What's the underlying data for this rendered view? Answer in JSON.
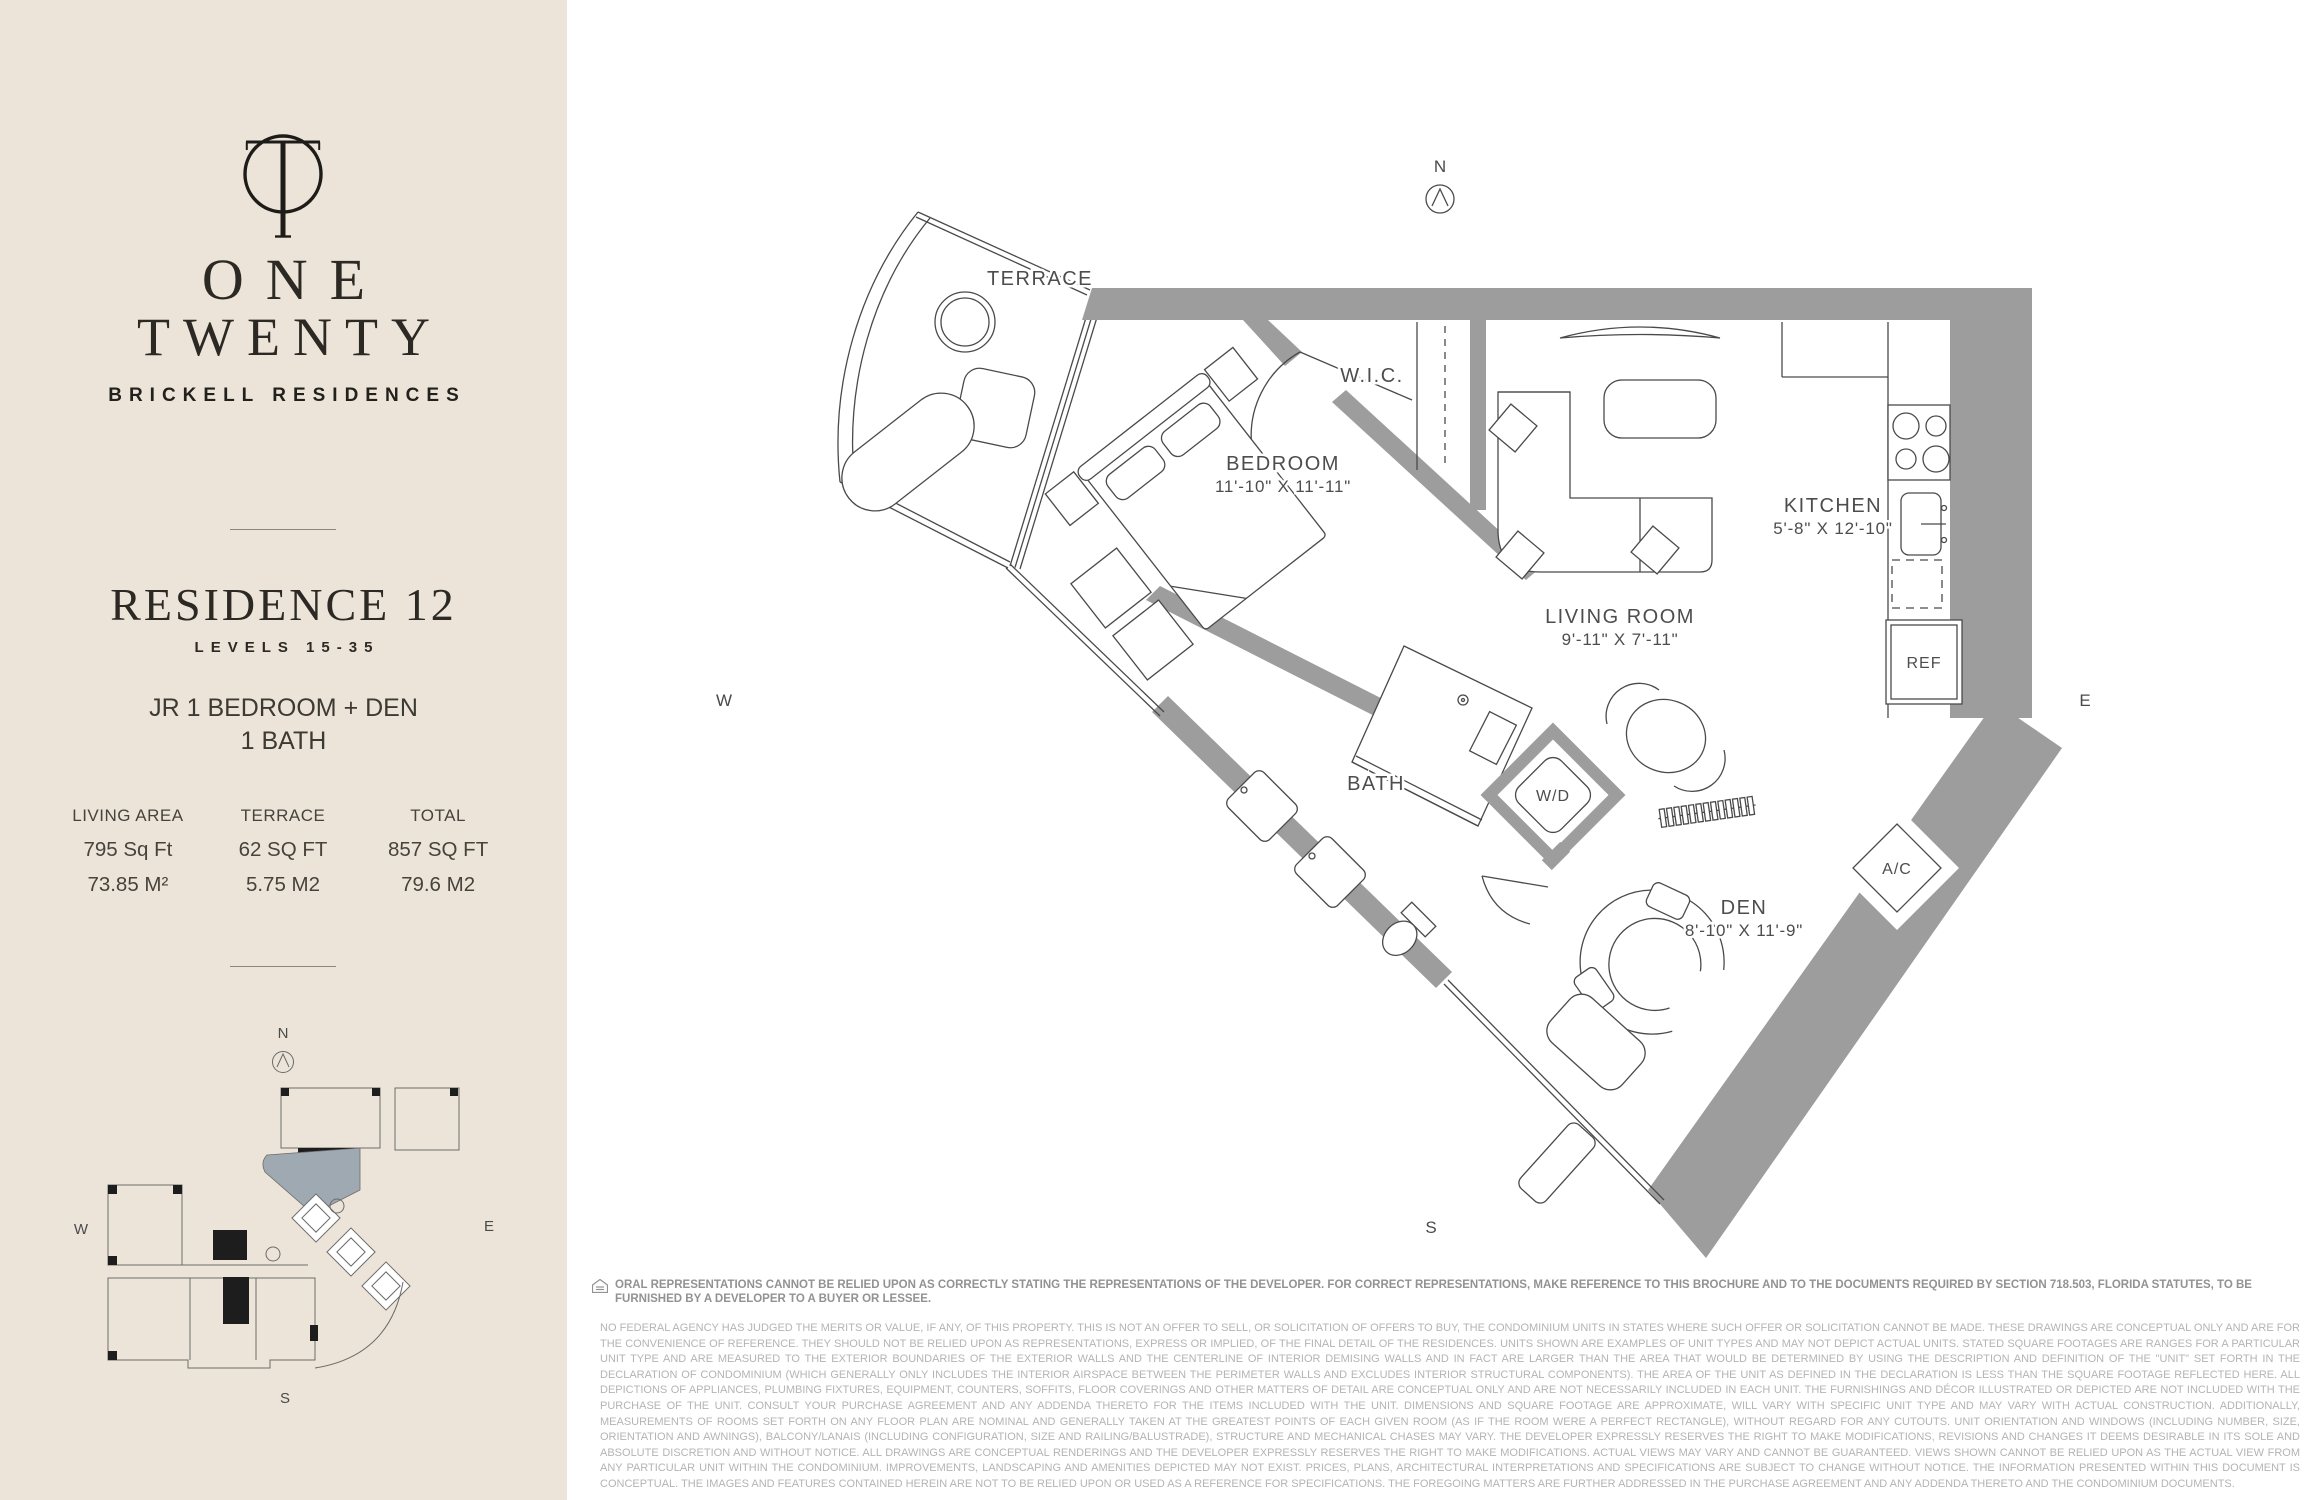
{
  "sidebar": {
    "bg_color": "#ece4d8",
    "brand": {
      "name_line1": "ONE",
      "name_line2": "TWENTY",
      "tagline": "BRICKELL RESIDENCES"
    },
    "residence": {
      "title": "RESIDENCE 12",
      "levels": "LEVELS 15-35",
      "type_line1": "JR 1 BEDROOM + DEN",
      "type_line2": "1 BATH"
    },
    "stats": {
      "columns": [
        {
          "label": "LIVING AREA",
          "imperial": "795 Sq Ft",
          "metric": "73.85 M²"
        },
        {
          "label": "TERRACE",
          "imperial": "62 SQ FT",
          "metric": "5.75 M2"
        },
        {
          "label": "TOTAL",
          "imperial": "857 SQ FT",
          "metric": "79.6 M2"
        }
      ]
    },
    "keyplan": {
      "highlight_color": "#9fa9b2",
      "compass": {
        "n": "N",
        "s": "S",
        "e": "E",
        "w": "W"
      }
    }
  },
  "floorplan": {
    "wall_color": "#9d9d9d",
    "compass": {
      "n": "N",
      "s": "S",
      "e": "E",
      "w": "W"
    },
    "rooms": {
      "terrace": {
        "name": "TERRACE"
      },
      "wic": {
        "name": "W.I.C."
      },
      "bedroom": {
        "name": "BEDROOM",
        "dims": "11'-10\" X 11'-11\""
      },
      "kitchen": {
        "name": "KITCHEN",
        "dims": "5'-8\" X 12'-10\""
      },
      "living": {
        "name": "LIVING ROOM",
        "dims": "9'-11\" X 7'-11\""
      },
      "bath": {
        "name": "BATH"
      },
      "wd": {
        "name": "W/D"
      },
      "den": {
        "name": "DEN",
        "dims": "8'-10\" X 11'-9\""
      },
      "ac": {
        "name": "A/C"
      },
      "ref": {
        "name": "REF"
      }
    }
  },
  "disclaimer": {
    "notice": "ORAL REPRESENTATIONS CANNOT BE RELIED UPON AS CORRECTLY STATING THE REPRESENTATIONS OF THE DEVELOPER. FOR CORRECT REPRESENTATIONS, MAKE REFERENCE TO THIS BROCHURE AND TO THE DOCUMENTS REQUIRED BY SECTION 718.503, FLORIDA STATUTES, TO BE FURNISHED BY A DEVELOPER TO A BUYER OR LESSEE.",
    "body": "NO FEDERAL AGENCY HAS JUDGED THE MERITS OR VALUE, IF ANY, OF THIS PROPERTY. THIS IS NOT AN OFFER TO SELL, OR SOLICITATION OF OFFERS TO BUY, THE CONDOMINIUM UNITS IN STATES WHERE SUCH OFFER OR SOLICITATION CANNOT BE MADE. THESE DRAWINGS ARE CONCEPTUAL ONLY AND ARE FOR THE CONVENIENCE OF REFERENCE. THEY SHOULD NOT BE RELIED UPON AS REPRESENTATIONS, EXPRESS OR IMPLIED, OF THE FINAL DETAIL OF THE RESIDENCES. UNITS SHOWN ARE EXAMPLES OF UNIT TYPES AND MAY NOT DEPICT ACTUAL UNITS. STATED SQUARE FOOTAGES ARE RANGES FOR A PARTICULAR UNIT TYPE AND ARE MEASURED TO THE EXTERIOR BOUNDARIES OF THE EXTERIOR WALLS AND THE CENTERLINE OF INTERIOR DEMISING WALLS AND IN FACT ARE LARGER THAN THE AREA THAT WOULD BE DETERMINED BY USING THE DESCRIPTION AND DEFINITION OF THE \"UNIT\" SET FORTH IN THE DECLARATION OF CONDOMINIUM (WHICH GENERALLY ONLY INCLUDES THE INTERIOR AIRSPACE BETWEEN THE PERIMETER WALLS AND EXCLUDES INTERIOR STRUCTURAL COMPONENTS). THE AREA OF THE UNIT AS DEFINED IN THE DECLARATION IS LESS THAN THE SQUARE FOOTAGE REFLECTED HERE. ALL DEPICTIONS OF APPLIANCES, PLUMBING FIXTURES, EQUIPMENT, COUNTERS, SOFFITS, FLOOR COVERINGS AND OTHER MATTERS OF DETAIL ARE CONCEPTUAL ONLY AND ARE NOT NECESSARILY INCLUDED IN EACH UNIT. THE FURNISHINGS AND DÉCOR ILLUSTRATED OR DEPICTED ARE NOT INCLUDED WITH THE PURCHASE OF THE UNIT. CONSULT YOUR PURCHASE AGREEMENT AND ANY ADDENDA THERETO FOR THE ITEMS INCLUDED WITH THE UNIT. DIMENSIONS AND SQUARE FOOTAGE ARE APPROXIMATE, WILL VARY WITH SPECIFIC UNIT TYPE AND MAY VARY WITH ACTUAL CONSTRUCTION. ADDITIONALLY, MEASUREMENTS OF ROOMS SET FORTH ON ANY FLOOR PLAN ARE NOMINAL AND GENERALLY TAKEN AT THE GREATEST POINTS OF EACH GIVEN ROOM (AS IF THE ROOM WERE A PERFECT RECTANGLE), WITHOUT REGARD FOR ANY CUTOUTS. UNIT ORIENTATION AND WINDOWS (INCLUDING NUMBER, SIZE, ORIENTATION AND AWNINGS), BALCONY/LANAIS (INCLUDING CONFIGURATION, SIZE AND RAILING/BALUSTRADE), STRUCTURE AND MECHANICAL CHASES MAY VARY. THE DEVELOPER EXPRESSLY RESERVES THE RIGHT TO MAKE MODIFICATIONS, REVISIONS AND CHANGES IT DEEMS DESIRABLE IN ITS SOLE AND ABSOLUTE DISCRETION AND WITHOUT NOTICE. ALL DRAWINGS ARE CONCEPTUAL RENDERINGS AND THE DEVELOPER EXPRESSLY RESERVES THE RIGHT TO MAKE MODIFICATIONS. ACTUAL VIEWS MAY VARY AND CANNOT BE GUARANTEED. VIEWS SHOWN CANNOT BE RELIED UPON AS THE ACTUAL VIEW FROM ANY PARTICULAR UNIT WITHIN THE CONDOMINIUM. IMPROVEMENTS, LANDSCAPING AND AMENITIES DEPICTED MAY NOT EXIST. PRICES, PLANS, ARCHITECTURAL INTERPRETATIONS AND SPECIFICATIONS ARE SUBJECT TO CHANGE WITHOUT NOTICE. THE INFORMATION PRESENTED WITHIN THIS DOCUMENT IS CONCEPTUAL. THE IMAGES AND FEATURES CONTAINED HEREIN ARE NOT TO BE RELIED UPON OR USED AS A REFERENCE FOR SPECIFICATIONS. THE FOREGOING MATTERS ARE FURTHER ADDRESSED IN THE PURCHASE AGREEMENT AND ANY ADDENDA THERETO AND THE CONDOMINIUM DOCUMENTS."
  }
}
